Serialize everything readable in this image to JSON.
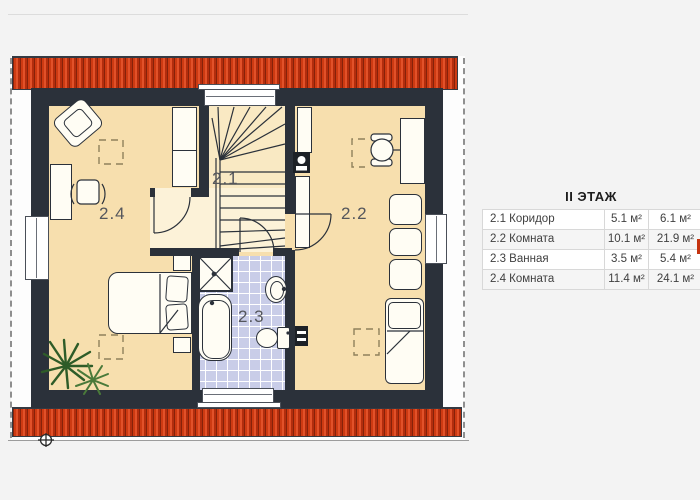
{
  "floor_plan": {
    "room_labels": {
      "corridor": "2.1",
      "room_right": "2.2",
      "bathroom": "2.3",
      "room_left": "2.4"
    },
    "colors": {
      "roof_red": "#c5330f",
      "wall_dark": "#2b313a",
      "room_floor": "#f7dfae",
      "corridor_floor": "#fcf2d8",
      "bathroom_tile": "#c9cde8",
      "plant_green": "#2e5c28"
    }
  },
  "area_table": {
    "title": "II ЭТАЖ",
    "rows": [
      {
        "label": "2.1 Коридор",
        "area_1": "5.1 м²",
        "area_2": "6.1 м²"
      },
      {
        "label": "2.2 Комната",
        "area_1": "10.1 м²",
        "area_2": "21.9 м²"
      },
      {
        "label": "2.3 Ванная",
        "area_1": "3.5 м²",
        "area_2": "5.4 м²"
      },
      {
        "label": "2.4 Комната",
        "area_1": "11.4 м²",
        "area_2": "24.1 м²"
      }
    ]
  }
}
